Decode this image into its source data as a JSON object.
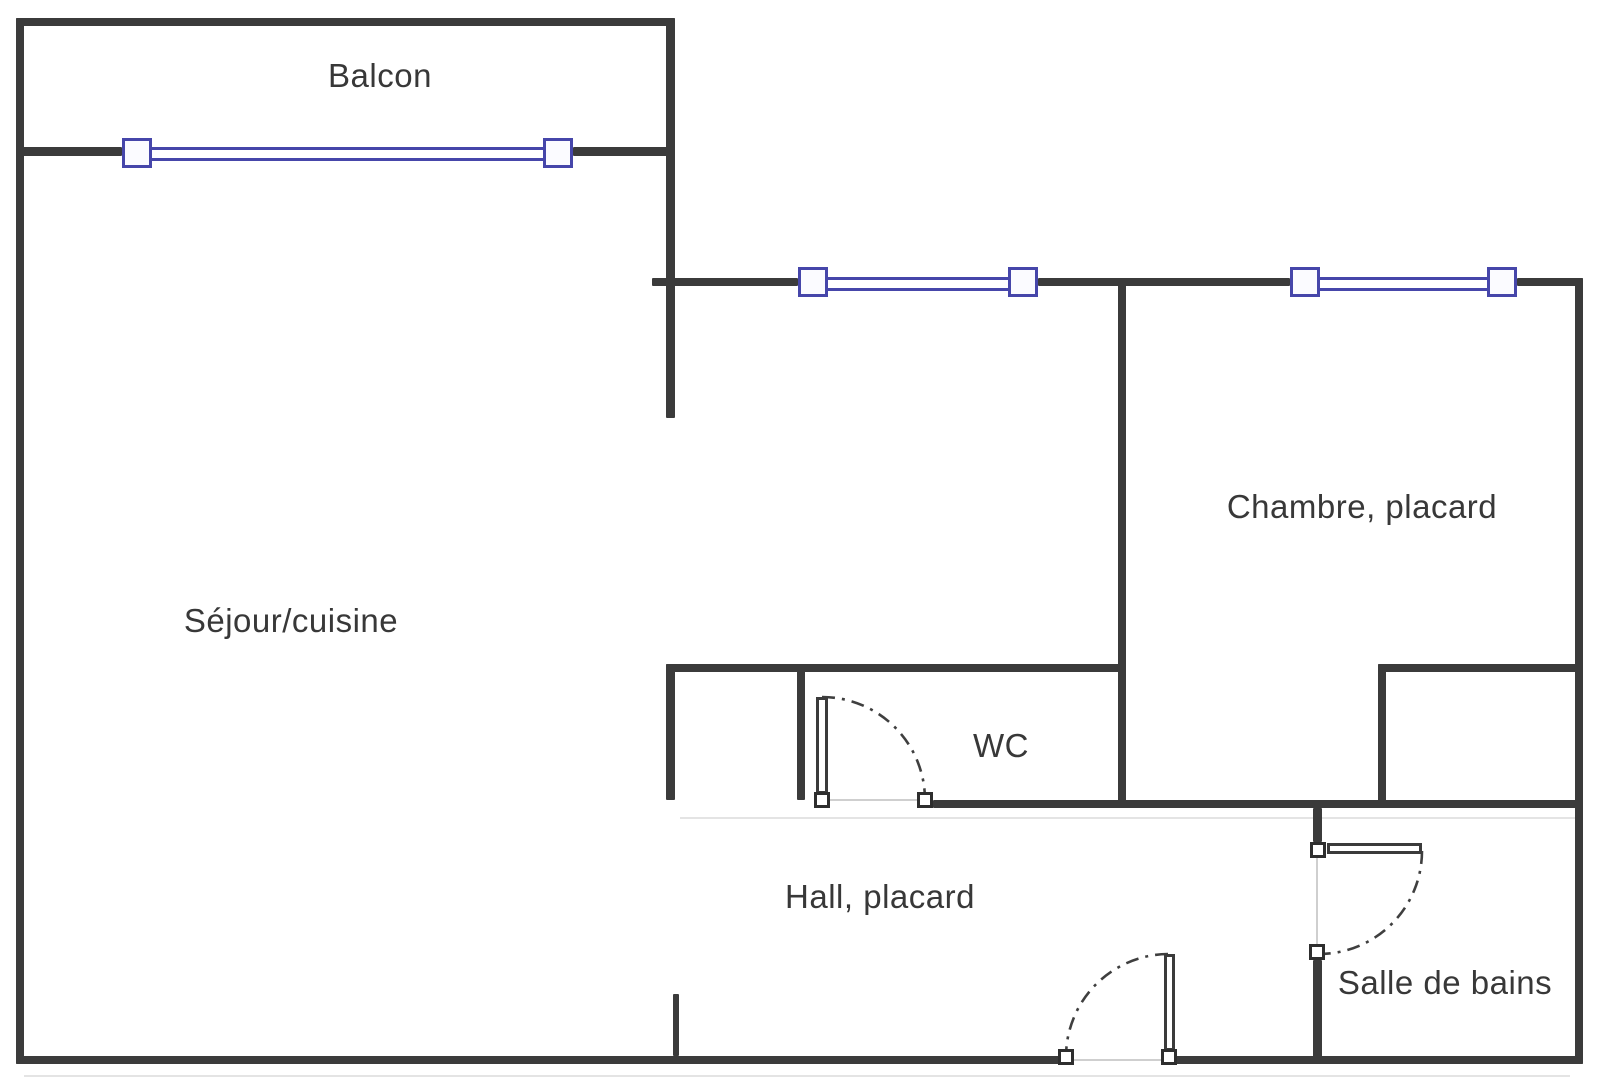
{
  "canvas": {
    "width": 1600,
    "height": 1089
  },
  "colors": {
    "background": "#ffffff",
    "wall": "#3b3b3b",
    "window_accent": "#4646aa",
    "window_fill": "#fbfbff",
    "door_arc": "#3f3f3f",
    "opening_line": "#cfcfcf",
    "label_text": "#383838"
  },
  "rooms": [
    {
      "id": "balcon",
      "label": "Balcon",
      "x": 380,
      "y": 76
    },
    {
      "id": "sejour",
      "label": "Séjour/cuisine",
      "x": 291,
      "y": 621
    },
    {
      "id": "chambre",
      "label": "Chambre, placard",
      "x": 1362,
      "y": 507
    },
    {
      "id": "wc",
      "label": "WC",
      "x": 1001,
      "y": 746
    },
    {
      "id": "hall",
      "label": "Hall, placard",
      "x": 880,
      "y": 897
    },
    {
      "id": "sdb",
      "label": "Salle de bains",
      "x": 1445,
      "y": 983
    }
  ],
  "walls": [
    {
      "id": "top-wall",
      "x": 16,
      "y": 18,
      "w": 659,
      "h": 8
    },
    {
      "id": "balcony-sill-left",
      "x": 16,
      "y": 147,
      "w": 106,
      "h": 9
    },
    {
      "id": "balcony-sill-right",
      "x": 573,
      "y": 147,
      "w": 102,
      "h": 9
    },
    {
      "id": "upper-wall-seg1",
      "x": 652,
      "y": 278,
      "w": 146,
      "h": 8
    },
    {
      "id": "upper-wall-seg2",
      "x": 1038,
      "y": 278,
      "w": 252,
      "h": 8
    },
    {
      "id": "upper-wall-seg3",
      "x": 1517,
      "y": 278,
      "w": 66,
      "h": 8
    },
    {
      "id": "wc-top-wall",
      "x": 666,
      "y": 664,
      "w": 460,
      "h": 8
    },
    {
      "id": "placard-top-wall",
      "x": 1378,
      "y": 664,
      "w": 205,
      "h": 8
    },
    {
      "id": "row-bottom-wall",
      "x": 933,
      "y": 800,
      "w": 650,
      "h": 8
    },
    {
      "id": "bottom-wall-left",
      "x": 16,
      "y": 1056,
      "w": 1058,
      "h": 8
    },
    {
      "id": "bottom-wall-right",
      "x": 1161,
      "y": 1056,
      "w": 422,
      "h": 8
    },
    {
      "id": "left-wall",
      "x": 16,
      "y": 18,
      "w": 8,
      "h": 1046
    },
    {
      "id": "right-wall",
      "x": 1575,
      "y": 278,
      "w": 8,
      "h": 786
    },
    {
      "id": "divider-upper",
      "x": 666,
      "y": 18,
      "w": 9,
      "h": 400
    },
    {
      "id": "divider-mid-stub",
      "x": 666,
      "y": 664,
      "w": 9,
      "h": 136
    },
    {
      "id": "wc-left-wall",
      "x": 797,
      "y": 664,
      "w": 8,
      "h": 136
    },
    {
      "id": "chambre-left-wall",
      "x": 1118,
      "y": 278,
      "w": 8,
      "h": 530
    },
    {
      "id": "placard-left-wall",
      "x": 1378,
      "y": 664,
      "w": 8,
      "h": 144
    },
    {
      "id": "sdb-door-connector",
      "x": 1313,
      "y": 808,
      "w": 9,
      "h": 34
    },
    {
      "id": "sdb-left-wall-lower",
      "x": 1313,
      "y": 960,
      "w": 9,
      "h": 104
    },
    {
      "id": "bottom-stub",
      "x": 673,
      "y": 994,
      "w": 6,
      "h": 62
    }
  ],
  "openings": [
    {
      "id": "wc-door-opening",
      "x": 830,
      "y": 799,
      "w": 87,
      "h": 2
    },
    {
      "id": "sdb-door-opening",
      "x": 1316,
      "y": 858,
      "w": 2,
      "h": 87
    },
    {
      "id": "entry-door-opening",
      "x": 1074,
      "y": 1059,
      "w": 87,
      "h": 2
    }
  ],
  "shadows": [
    {
      "id": "row-wall-shadow",
      "x": 680,
      "y": 817,
      "w": 895,
      "h": 2
    },
    {
      "id": "bottom-wall-shadow",
      "x": 24,
      "y": 1075,
      "w": 1546,
      "h": 2
    }
  ],
  "windows": [
    {
      "id": "window-balcon",
      "squares": [
        [
          122,
          138
        ],
        [
          543,
          138
        ]
      ],
      "rails": [
        {
          "x": 152,
          "y": 147,
          "w": 391
        },
        {
          "x": 152,
          "y": 158,
          "w": 391
        }
      ]
    },
    {
      "id": "window-hall-top",
      "squares": [
        [
          798,
          267
        ],
        [
          1008,
          267
        ]
      ],
      "rails": [
        {
          "x": 828,
          "y": 277,
          "w": 180
        },
        {
          "x": 828,
          "y": 288,
          "w": 180
        }
      ]
    },
    {
      "id": "window-chambre",
      "squares": [
        [
          1290,
          267
        ],
        [
          1487,
          267
        ]
      ],
      "rails": [
        {
          "x": 1320,
          "y": 277,
          "w": 167
        },
        {
          "x": 1320,
          "y": 288,
          "w": 167
        }
      ]
    }
  ],
  "doors": [
    {
      "id": "door-wc",
      "hinge": [
        814,
        792
      ],
      "latch": [
        917,
        792
      ],
      "leaf": {
        "x": 816,
        "y": 697,
        "w": 12,
        "h": 97
      },
      "arc": "M 822 697 A 103 103 0 0 1 925 800"
    },
    {
      "id": "door-sdb",
      "hinge": [
        1310,
        842
      ],
      "latch": [
        1309,
        944
      ],
      "leaf": {
        "x": 1327,
        "y": 843,
        "w": 95,
        "h": 11
      },
      "arc": "M 1422 851 A 103 103 0 0 1 1319 954"
    },
    {
      "id": "door-entry",
      "hinge": [
        1161,
        1049
      ],
      "latch": [
        1058,
        1049
      ],
      "leaf": {
        "x": 1164,
        "y": 954,
        "w": 11,
        "h": 97
      },
      "arc": "M 1168 954 A 103 103 0 0 0 1066 1057"
    }
  ]
}
